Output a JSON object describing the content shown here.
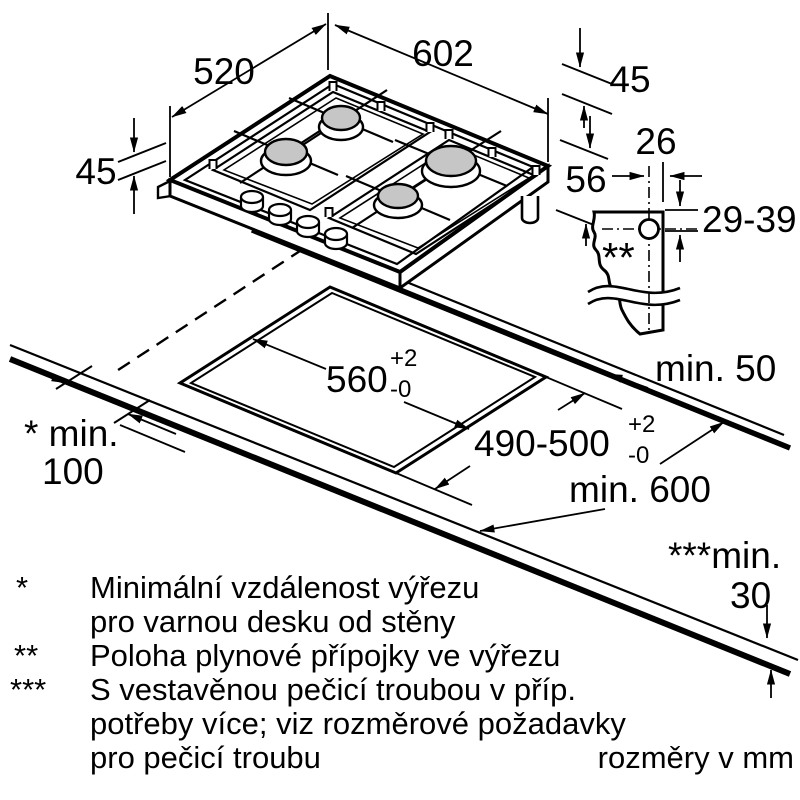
{
  "diagram": {
    "hob": {
      "width": "602",
      "depth": "520",
      "height_left": "45",
      "height_right": "45",
      "depth_below_top": "56"
    },
    "detail": {
      "connection_offset": "26",
      "connection_range": "29-39",
      "marker": "**"
    },
    "cutout": {
      "width": "560",
      "depth": "490-500",
      "tol_plus": "+2",
      "tol_minus": "-0"
    },
    "clearances": {
      "back": "min. 50",
      "side_label": "* min.",
      "side_value": "100",
      "depth_label": "min. 600",
      "front_label": "***min.",
      "front_value": "30"
    }
  },
  "legend": {
    "items": [
      {
        "marker": "*",
        "lines": [
          "Minimální vzdálenost výřezu",
          "pro varnou desku od stěny"
        ]
      },
      {
        "marker": "**",
        "lines": [
          "Poloha plynové přípojky ve výřezu"
        ]
      },
      {
        "marker": "***",
        "lines": [
          "S vestavěnou pečicí troubou v příp.",
          "potřeby více; viz rozměrové požadavky",
          "pro pečicí troubu"
        ]
      }
    ],
    "units_note": "rozměry v mm"
  }
}
